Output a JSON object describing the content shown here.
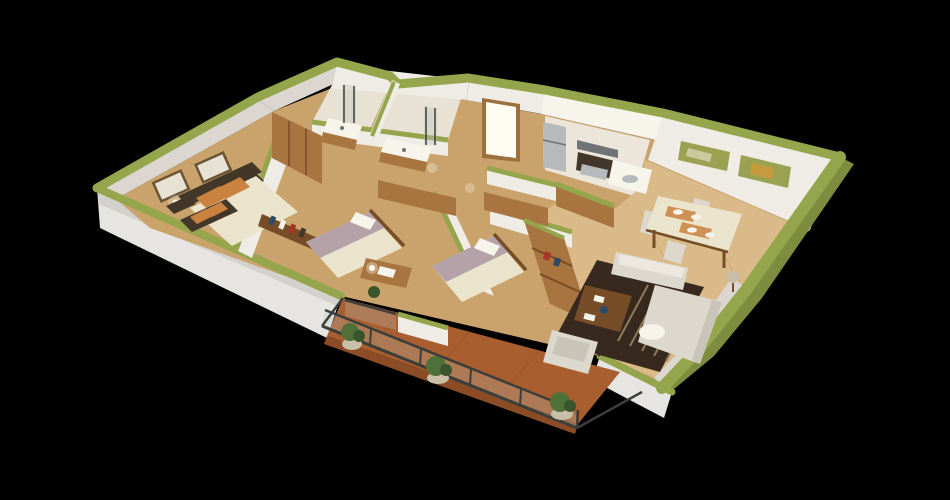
{
  "scene": {
    "description": "isometric 3D apartment floor-plan render on black background",
    "background": "#000000",
    "canvas": {
      "width": 950,
      "height": 500
    }
  },
  "rooms": [
    {
      "id": "master-bedroom"
    },
    {
      "id": "bathroom-ensuite"
    },
    {
      "id": "bathroom-main"
    },
    {
      "id": "hallway-entry"
    },
    {
      "id": "kitchen"
    },
    {
      "id": "dining-area"
    },
    {
      "id": "living-area"
    },
    {
      "id": "bedroom-2"
    },
    {
      "id": "bedroom-3"
    },
    {
      "id": "balcony-terrace"
    }
  ],
  "palette": {
    "bg": "#000000",
    "cap": "#95a54b",
    "capDark": "#7d8c3e",
    "wall": "#efece6",
    "wallShade": "#dbd7d0",
    "wallDark": "#c6c2ba",
    "plinth": "#e7e5e1",
    "plinthShade": "#d3d1cc",
    "woodBase": "#c9a36b",
    "woodLight": "#d9ba88",
    "bathFloor": "#e8e2d4",
    "kitchenFloor": "#ece6da",
    "terracotta": "#a95e2f",
    "terracottaDark": "#8c4c26",
    "rug": "#37291d",
    "rugStripe": "#8d7b5a",
    "sofa": "#dcd8cd",
    "sofaShade": "#c8c4b8",
    "furnWood": "#a87440",
    "furnWoodDark": "#774d27",
    "bedCream": "#ebe4cd",
    "bedMauve": "#b5a2a8",
    "pillowOrange": "#c9833f",
    "darkFrame": "#423729",
    "appliance": "#b7babc",
    "applianceDark": "#6f7375",
    "glass": "#b9c4bd",
    "railing": "#3b3e3b",
    "plant": "#4f7038",
    "plantDark": "#3a552b",
    "pot": "#c9bfa9",
    "glow": "#fffdf2",
    "doorFrame": "#9c6f3e",
    "artOlive": "#9aa150",
    "artGold": "#c79b3d",
    "white": "#f7f4eb",
    "accentRed": "#a83326",
    "accentBlue": "#2e4a6b"
  }
}
